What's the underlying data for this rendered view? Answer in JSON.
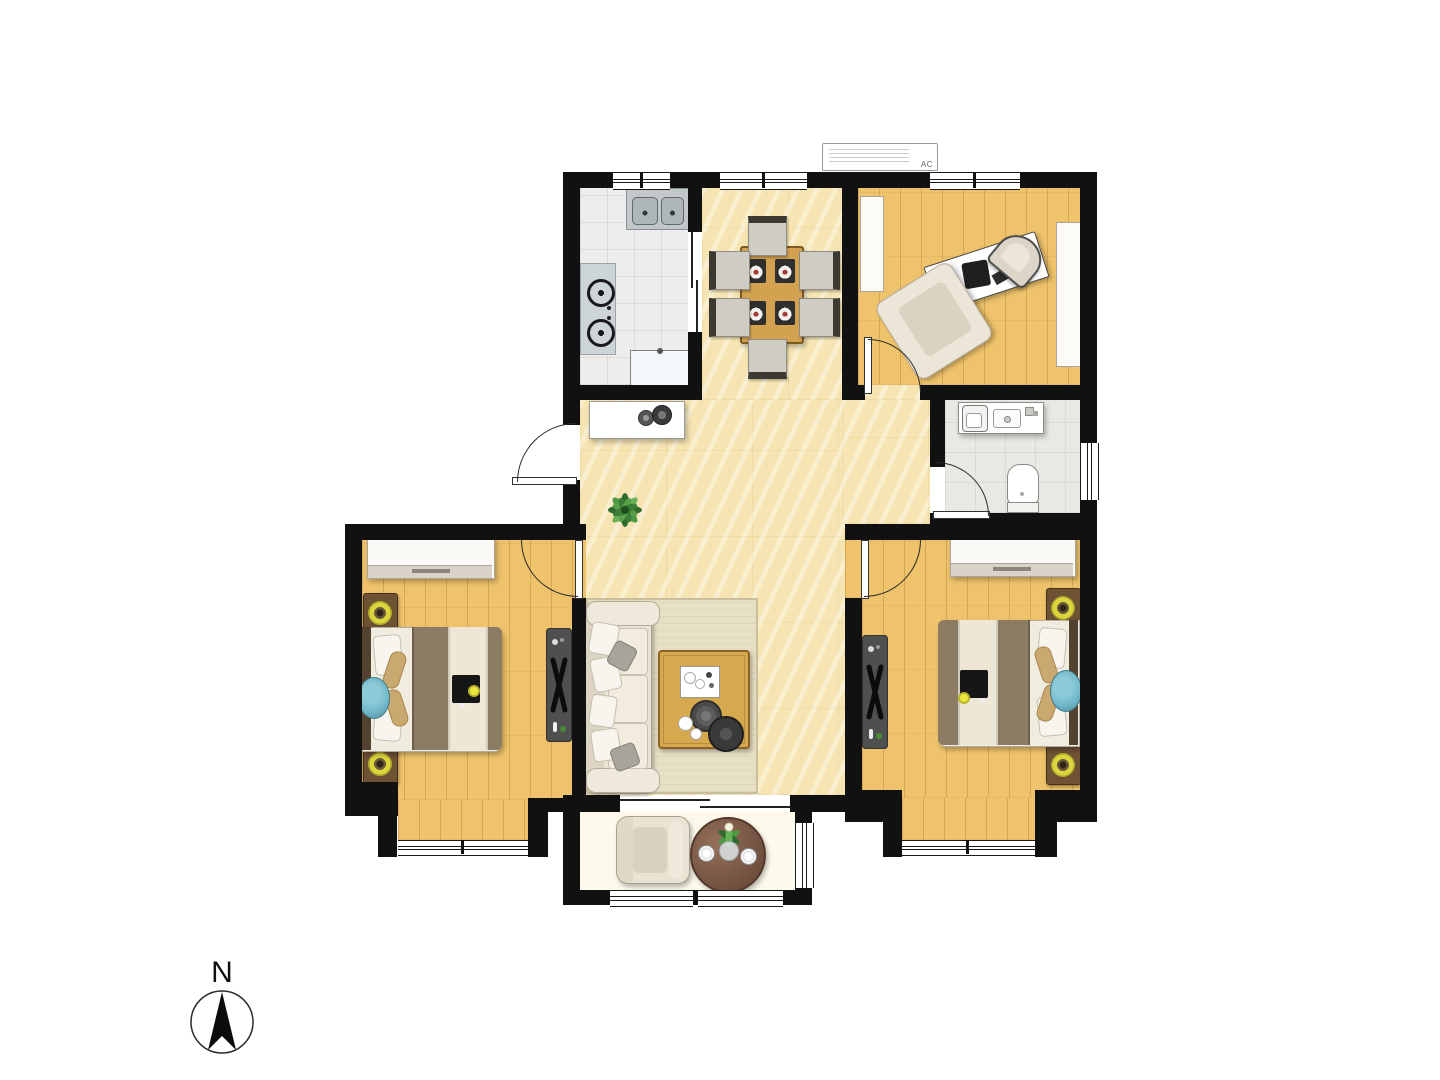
{
  "labels": {
    "ac_unit": "AC",
    "compass_north": "N"
  },
  "palette": {
    "wall": "#111111",
    "line": "#1a1a1a",
    "marble_floor": "#f6e5b2",
    "wood_floor": "#efc36b",
    "kitchen_tile": "#eeedeb",
    "bath_tile": "#e9e8e4",
    "balcony_floor": "#fdfaeb",
    "rug": "#e8e0c4",
    "sofa_cream": "#e9e3d4",
    "table_wood": "#d7a94f",
    "dining_wood": "#d2a251",
    "bed_blanket": "#8d7c64",
    "bed_sheet": "#f1ece0",
    "pillow_tan": "#c9a96f",
    "cushion_teal": "#6fb7c9",
    "nightstand_wood": "#6f5134",
    "lamp_yellow": "#dcd63e",
    "tv_stand": "#4f4f4f",
    "balcony_table": "#7d5b49",
    "plant_green": "#3f8f3a"
  }
}
